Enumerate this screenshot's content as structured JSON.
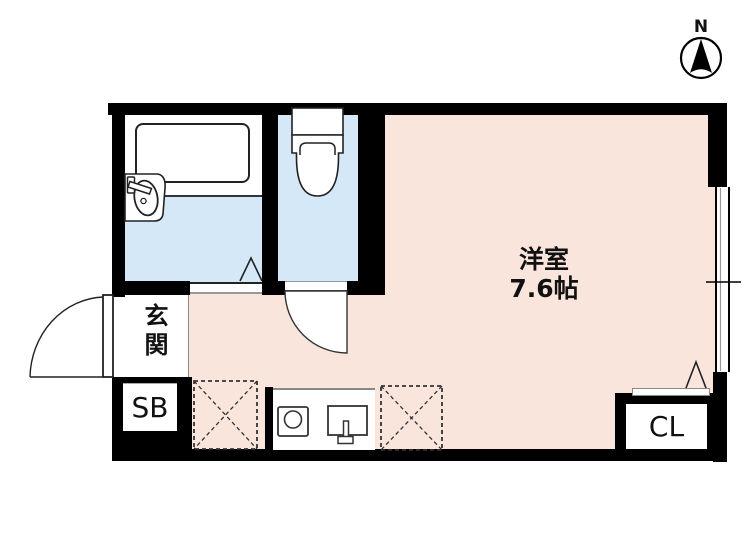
{
  "compass": {
    "label": "N"
  },
  "rooms": {
    "living": {
      "name": "洋室",
      "size": "7.6帖"
    },
    "entrance": {
      "name": "玄関"
    },
    "shoe_box": {
      "label": "SB"
    },
    "closet": {
      "label": "CL"
    },
    "bathroom": {
      "fixtures": [
        "bathtub",
        "washbasin"
      ]
    },
    "toilet": {
      "fixtures": [
        "toilet"
      ]
    }
  },
  "kitchen": {
    "fixtures": [
      "single-burner-stove",
      "kitchen-sink"
    ]
  },
  "appliance_spaces": [
    "washing-machine-space",
    "refrigerator-space"
  ],
  "doors": [
    "entrance-swing-door",
    "bathroom-folding-door",
    "toilet-swing-door",
    "closet-door"
  ],
  "window": {
    "position": "right-wall",
    "type": "sliding"
  },
  "colors": {
    "wall": "#000000",
    "floor_main": "#fae5dd",
    "floor_wet": "#d5e8f7",
    "fixture_outline": "#222222"
  }
}
